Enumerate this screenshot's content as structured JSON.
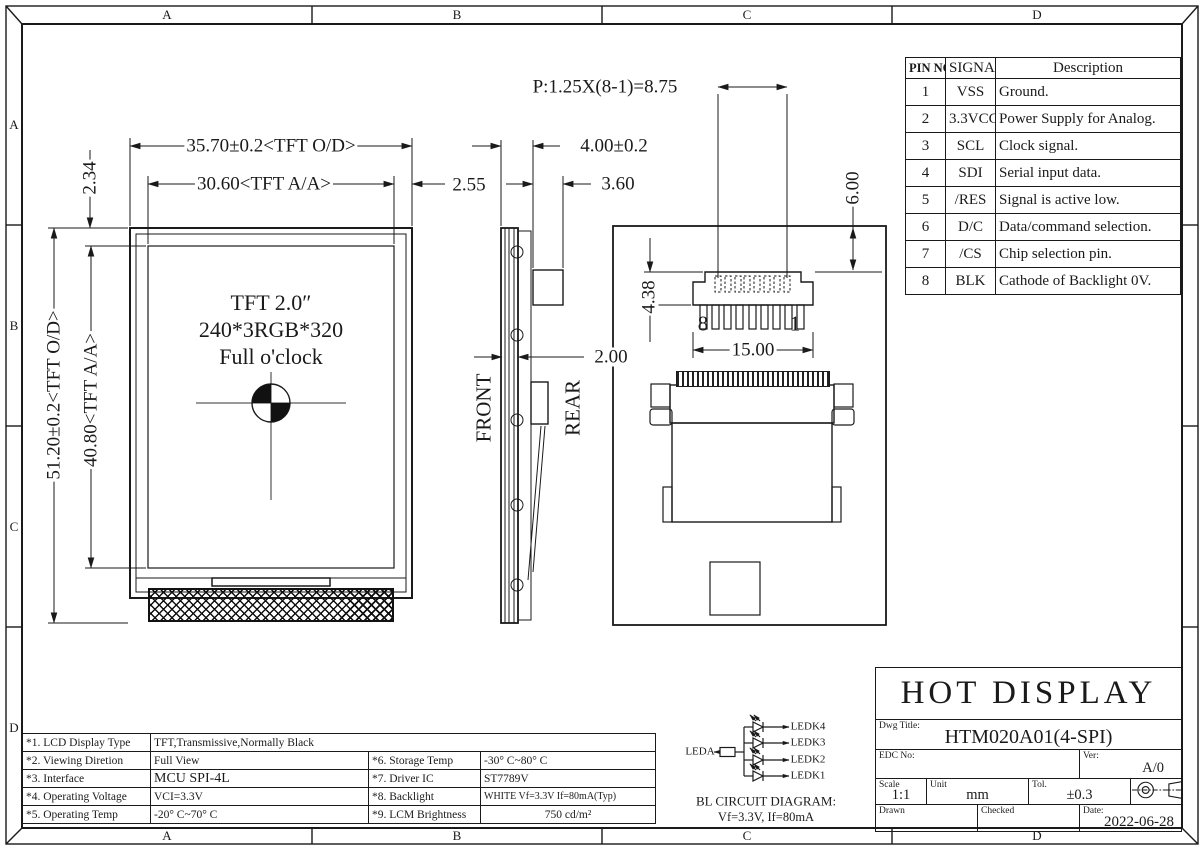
{
  "sheet": {
    "zones_top": [
      "A",
      "B",
      "C",
      "D"
    ],
    "zones_bottom": [
      "A",
      "B",
      "C",
      "D"
    ],
    "zones_left": [
      "A",
      "B",
      "C",
      "D"
    ]
  },
  "front_view": {
    "display_text_line1": "TFT 2.0″",
    "display_text_line2": "240*3RGB*320",
    "display_text_line3": "Full o'clock",
    "dim_width_outline": "35.70±0.2<TFT O/D>",
    "dim_width_active": "30.60<TFT A/A>",
    "dim_edge_right": "2.55",
    "dim_edge_top": "2.34",
    "dim_height_outline": "51.20±0.2<TFT O/D>",
    "dim_height_active": "40.80<TFT A/A>"
  },
  "side_view": {
    "label_front": "FRONT",
    "label_rear": "REAR",
    "dim_total_thickness": "4.00±0.2",
    "dim_connector_thickness": "3.60",
    "dim_panel_thickness": "2.00"
  },
  "rear_view": {
    "dim_pitch": "P:1.25X(8-1)=8.75",
    "dim_tail_offset": "6.00",
    "dim_tail_height": "4.38",
    "dim_tail_width": "15.00",
    "pin_last": "8",
    "pin_first": "1"
  },
  "pin_table": {
    "headers": [
      "PIN NO.",
      "SIGNAL",
      "Description"
    ],
    "rows": [
      [
        "1",
        "VSS",
        "Ground."
      ],
      [
        "2",
        "3.3VCC",
        "Power Supply for Analog."
      ],
      [
        "3",
        "SCL",
        "Clock signal."
      ],
      [
        "4",
        "SDI",
        "Serial input data."
      ],
      [
        "5",
        "/RES",
        "Signal is active low."
      ],
      [
        "6",
        "D/C",
        "Data/command selection."
      ],
      [
        "7",
        "/CS",
        "Chip selection pin."
      ],
      [
        "8",
        "BLK",
        "Cathode of Backlight 0V."
      ]
    ]
  },
  "spec_table": {
    "rows": [
      {
        "k": "*1. LCD Display Type",
        "v": "TFT,Transmissive,Normally Black",
        "k2": "",
        "v2": ""
      },
      {
        "k": "*2. Viewing Diretion",
        "v": "Full View",
        "k2": "*6. Storage Temp",
        "v2": "-30° C~80° C"
      },
      {
        "k": "*3. Interface",
        "v": "MCU SPI-4L",
        "k2": "*7. Driver IC",
        "v2": "ST7789V"
      },
      {
        "k": "*4. Operating Voltage",
        "v": "VCI=3.3V",
        "k2": "*8. Backlight",
        "v2": "WHITE Vf=3.3V If=80mA(Typ)"
      },
      {
        "k": "*5. Operating Temp",
        "v": "-20° C~70° C",
        "k2": "*9. LCM Brightness",
        "v2": "750 cd/m²"
      }
    ]
  },
  "bl_circuit": {
    "anode": "LEDA",
    "cathodes": [
      "LEDK4",
      "LEDK3",
      "LEDK2",
      "LEDK1"
    ],
    "caption1": "BL CIRCUIT DIAGRAM:",
    "caption2": "Vf=3.3V, If=80mA"
  },
  "title_block": {
    "company": "HOT DISPLAY",
    "dwg_title_label": "Dwg Title:",
    "dwg_title": "HTM020A01(4-SPI)",
    "edc_label": "EDC No:",
    "ver_label": "Ver:",
    "version": "A/0",
    "scale_label": "Scale",
    "scale": "1:1",
    "unit_label": "Unit",
    "unit": "mm",
    "tol_label": "Tol.",
    "tolerance": "±0.3",
    "drawn_label": "Drawn",
    "checked_label": "Checked",
    "date_label": "Date:",
    "date": "2022-06-28"
  }
}
